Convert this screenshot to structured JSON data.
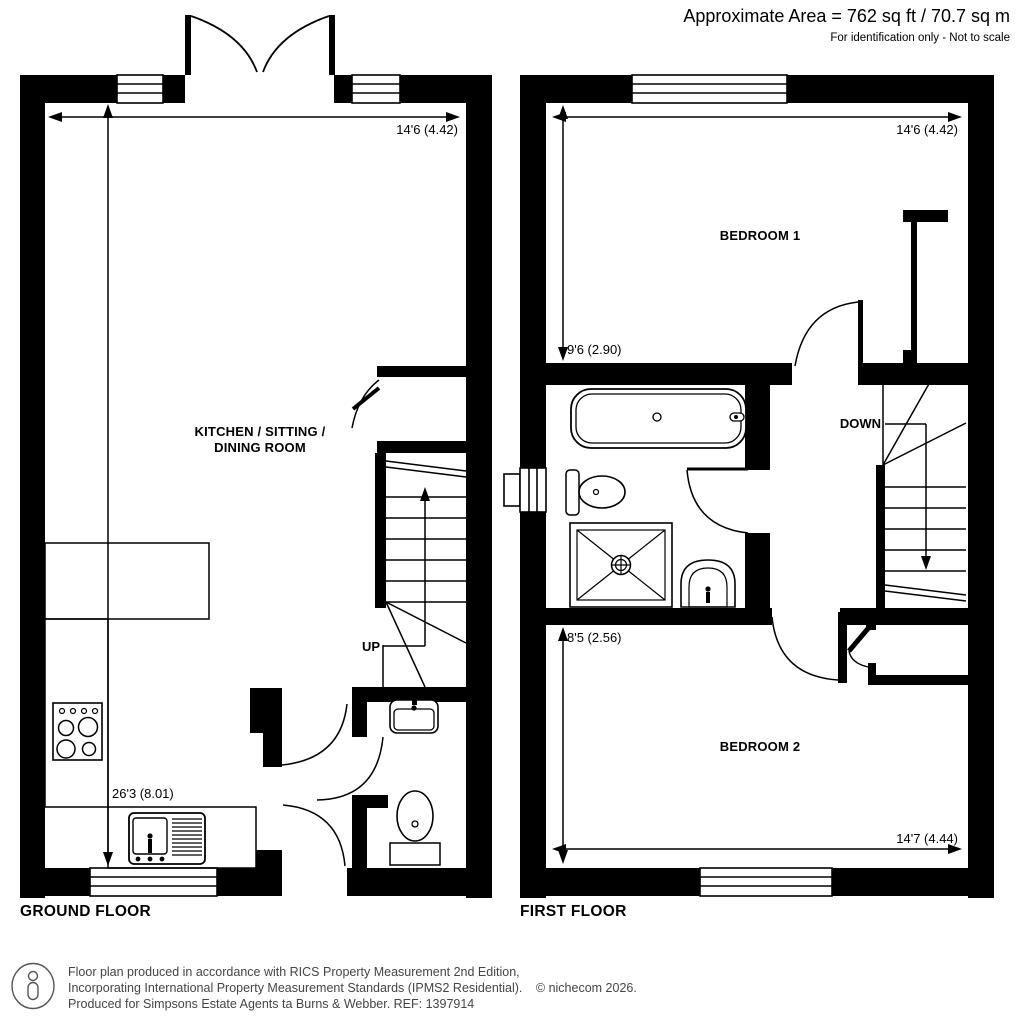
{
  "header": {
    "area": "Approximate Area = 762 sq ft / 70.7 sq m",
    "disclaimer": "For identification only - Not to scale"
  },
  "ground_floor": {
    "title": "GROUND FLOOR",
    "room_line1": "KITCHEN / SITTING /",
    "room_line2": "DINING ROOM",
    "dim_width": "14'6 (4.42)",
    "dim_length": "26'3 (8.01)",
    "stair_label": "UP"
  },
  "first_floor": {
    "title": "FIRST FLOOR",
    "bedroom1_label": "BEDROOM 1",
    "bedroom1_width": "14'6 (4.42)",
    "bedroom1_depth": "9'6 (2.90)",
    "bedroom2_label": "BEDROOM 2",
    "bedroom2_width": "14'7 (4.44)",
    "bedroom2_depth": "8'5 (2.56)",
    "stair_label": "DOWN"
  },
  "footer": {
    "line1": "Floor plan produced in accordance with RICS Property Measurement 2nd Edition,",
    "line2": "Incorporating International Property Measurement Standards (IPMS2 Residential).",
    "copyright": "© nichecom 2026.",
    "line3": "Produced for Simpsons Estate Agents ta Burns & Webber.   REF:  1397914"
  },
  "colors": {
    "wall": "#000000",
    "background": "#ffffff",
    "footer_text": "#454545"
  }
}
